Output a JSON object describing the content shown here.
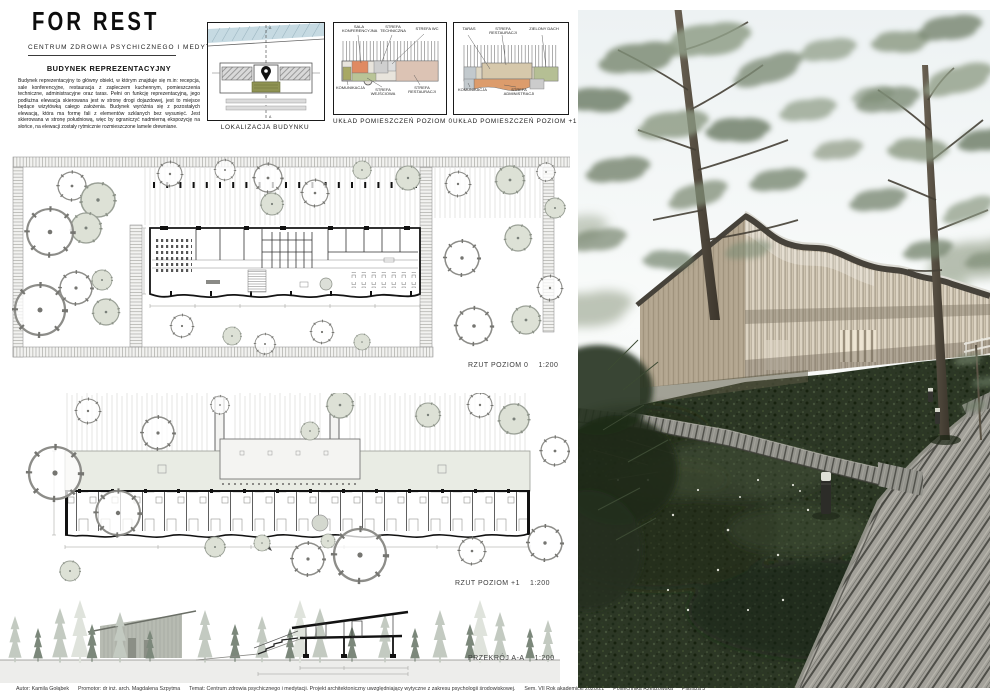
{
  "header": {
    "logo": "FOR REST",
    "subtitle": "CENTRUM ZDROWIA PSYCHICZNEGO I MEDYTACJI"
  },
  "intro": {
    "title": "BUDYNEK REPREZENTACYJNY",
    "body": "Budynek reprezentacyjny to główny obiekt, w którym znajduje się m.in: recepcja, sale konferencyjne, restauracja z zapleczem kuchennym, pomieszczenia techniczne, administracyjne oraz taras. Pełni on funkcję reprezentacyjną, jego podłużna elewacja skierowana jest w stronę drogi dojazdowej, jest to miejsce będące wizytówką całego założenia. Budynek wyróżnia się z pozostałych elewacją, która ma formę fali z elementów szklanych bez wysunięć. Jest skierowana w stronę południową, więc by ograniczyć nadmierną ekspozycję na słońce, na elewacji zostały rytmicznie rozmieszczone lamele drewniane."
  },
  "diagrams": {
    "location": {
      "caption": "LOKALIZACJA BUDYNKU",
      "mark_top": "A",
      "mark_bottom": "A"
    },
    "level0": {
      "caption": "UKŁAD POMIESZCZEŃ POZIOM 0",
      "labels_top": [
        "SALA KONFERENCYJNA",
        "STREFA TECHNICZNA",
        "STREFA WC"
      ],
      "labels_bottom": [
        "KOMUNIKACJA",
        "STREFA WEJŚCIOWA",
        "STREFA RESTAURACJI"
      ]
    },
    "level1": {
      "caption": "UKŁAD POMIESZCZEŃ POZIOM +1",
      "labels_top": [
        "TARAS",
        "STREFA RESTAURACJI",
        "ZIELONY DACH"
      ],
      "labels_bottom": [
        "KOMUNIKACJA",
        "STREFA ADMINISTRACJI"
      ]
    }
  },
  "plans": {
    "plan0": {
      "label": "RZUT POZIOM 0",
      "scale": "1:200"
    },
    "plan1": {
      "label": "RZUT POZIOM +1",
      "scale": "1:200"
    },
    "section": {
      "label": "PRZEKRÓJ A-A",
      "scale": "1:200"
    }
  },
  "footer": {
    "author": "Autor: Kamila Gołąbek",
    "promotor": "Promotor: dr inż. arch. Magdalena Szpytma",
    "temat": "Temat: Centrum zdrowia psychicznego i medytacji. Projekt architektoniczny uwzględniający wytyczne z zakresu psychologii środowiskowej.",
    "sem": "Sem. VII Rok akademicki 2020/21",
    "uczelnia": "Politechnika Rzeszowska",
    "plansza": "Plansza 3"
  },
  "colors": {
    "water": "#c6dae2",
    "olive_building": "#8f9353",
    "zone_conference": "#e08a62",
    "zone_technical": "#cfcfcf",
    "zone_wc": "#dedede",
    "zone_restaurant": "#dcc3b4",
    "zone_entrance": "#b9c497",
    "zone_communication": "#a8a864",
    "zone_admin": "#dc9c6c",
    "zone_green_roof": "#b5bf94",
    "zone_terrace": "#d6c8ab",
    "render_wood": "#cfc5b1",
    "render_roof": "#46423a",
    "render_ground": "#2b3524"
  }
}
